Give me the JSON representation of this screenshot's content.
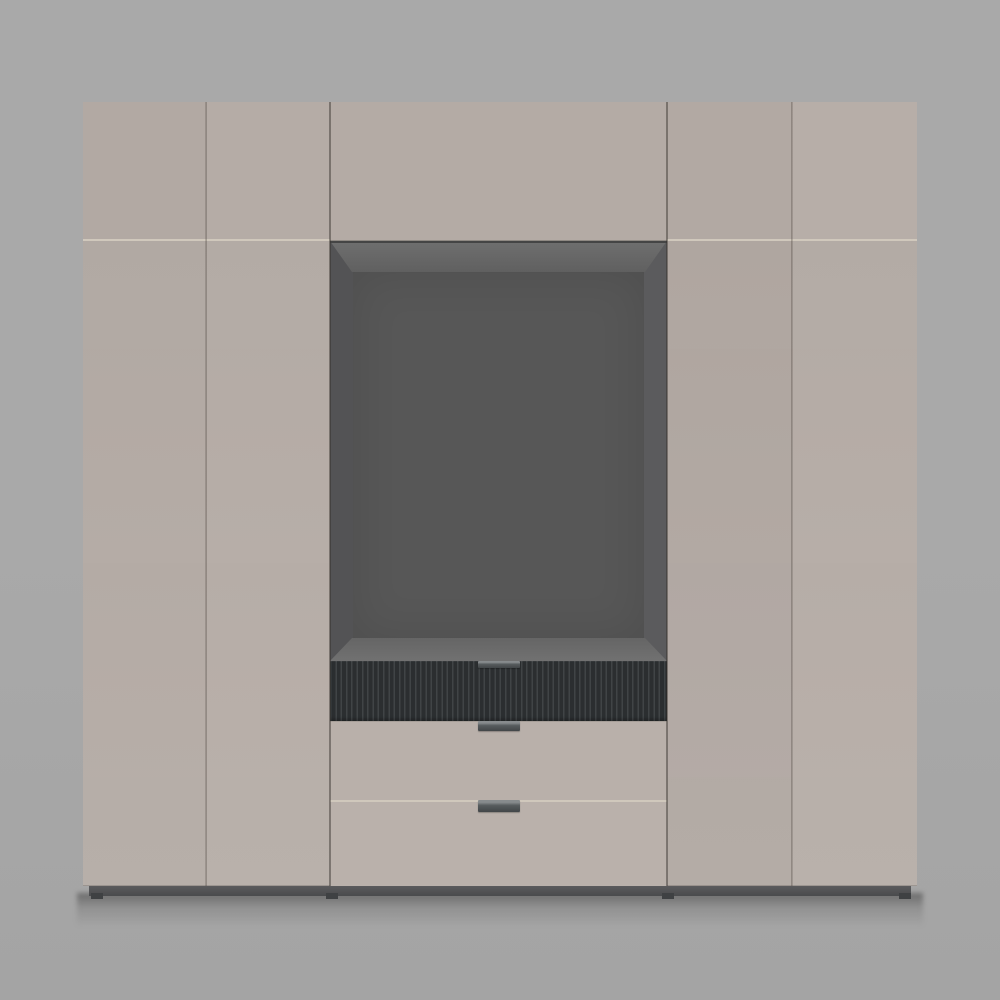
{
  "scene": {
    "type": "3d-furniture-render",
    "description": "Front elevation render of a wide beige wardrobe wall unit: a row of five top cabinet doors, two tall hinged doors on each side, and a central stack with an open dark media niche, a fluted charcoal drawer and two flat beige drawers with recessed dark metal bar handles, standing on a dark grey plinth against a plain grey studio background.",
    "background_top": "#a9a9a9",
    "background_bottom": "#a4a4a4"
  },
  "palette": {
    "bg_top": "#a9a9a9",
    "bg_bottom": "#a4a4a4",
    "door": "#b5aca6",
    "door_light": "#b7aea8",
    "door_dark": "#b2a9a3",
    "flap": "#b4aba5",
    "drawer_mid": "#b9b0aa",
    "drawer_bottom": "#bab1ab",
    "seam_light": "#d0c8bc",
    "niche_lip": "#454545",
    "niche_back": "#575757",
    "niche_wall_left": "#535355",
    "niche_wall_right": "#5b5b5d",
    "niche_ceiling": "#6f6f6f",
    "niche_ceiling_deep": "#606060",
    "niche_floor_back": "#656565",
    "niche_floor_front": "#717171",
    "flute_groove": "#2b2e30",
    "flute_ridge": "#404446",
    "handle_top": "#878b8d",
    "handle_body": "#575c5e",
    "handle_bottom": "#424648",
    "plinth_top": "#5b5b5d",
    "plinth_bottom": "#4a4b4d",
    "foot": "#3f4143"
  },
  "wardrobe": {
    "top_cabinet_doors": 5,
    "tall_doors_left": 2,
    "tall_doors_right": 2,
    "center_stack": [
      "open media niche",
      "fluted drawer",
      "flat drawer",
      "flat drawer"
    ],
    "handle_count": 3,
    "handle_style": "recessed dark metal bar"
  }
}
